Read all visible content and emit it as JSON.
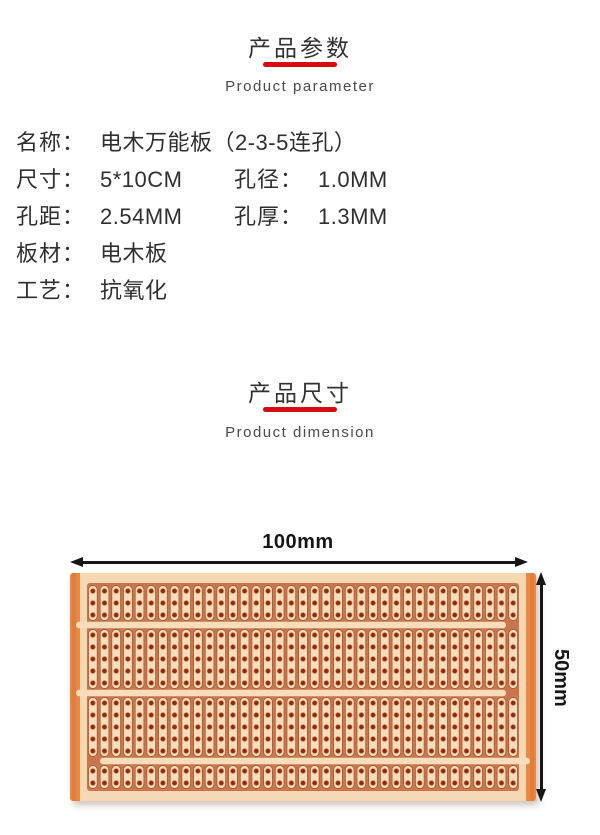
{
  "accent_color": "#d80a12",
  "dimension_arrow_color": "#161616",
  "section_params": {
    "title_zh": "产品参数",
    "title_en": "Product parameter"
  },
  "specs": {
    "rows": [
      [
        {
          "label": "名称：",
          "value": "电木万能板（2-3-5连孔）"
        }
      ],
      [
        {
          "label": "尺寸：",
          "value": "5*10CM"
        },
        {
          "label": "孔径：",
          "value": "1.0MM"
        }
      ],
      [
        {
          "label": "孔距：",
          "value": "2.54MM"
        },
        {
          "label": "孔厚：",
          "value": "1.3MM"
        }
      ],
      [
        {
          "label": "板材：",
          "value": "电木板"
        }
      ],
      [
        {
          "label": "工艺：",
          "value": "抗氧化"
        }
      ]
    ]
  },
  "section_dimension": {
    "title_zh": "产品尺寸",
    "title_en": "Product dimension",
    "width_label": "100mm",
    "height_label": "50mm"
  },
  "board": {
    "columns": 37,
    "bands": [
      3,
      5,
      5,
      2
    ],
    "hole_row_pitch": 12,
    "colors": {
      "edge": "#e98844",
      "edge_dark": "#dd7733",
      "margin": "#f6d7b3",
      "field": "#c9764c",
      "strip_fill": "#f8ddbd",
      "strip_stroke": "#a0512a",
      "hole": "#8c2b11",
      "hole_ring": "#c4713f",
      "separator": "#f8ddbd"
    }
  }
}
